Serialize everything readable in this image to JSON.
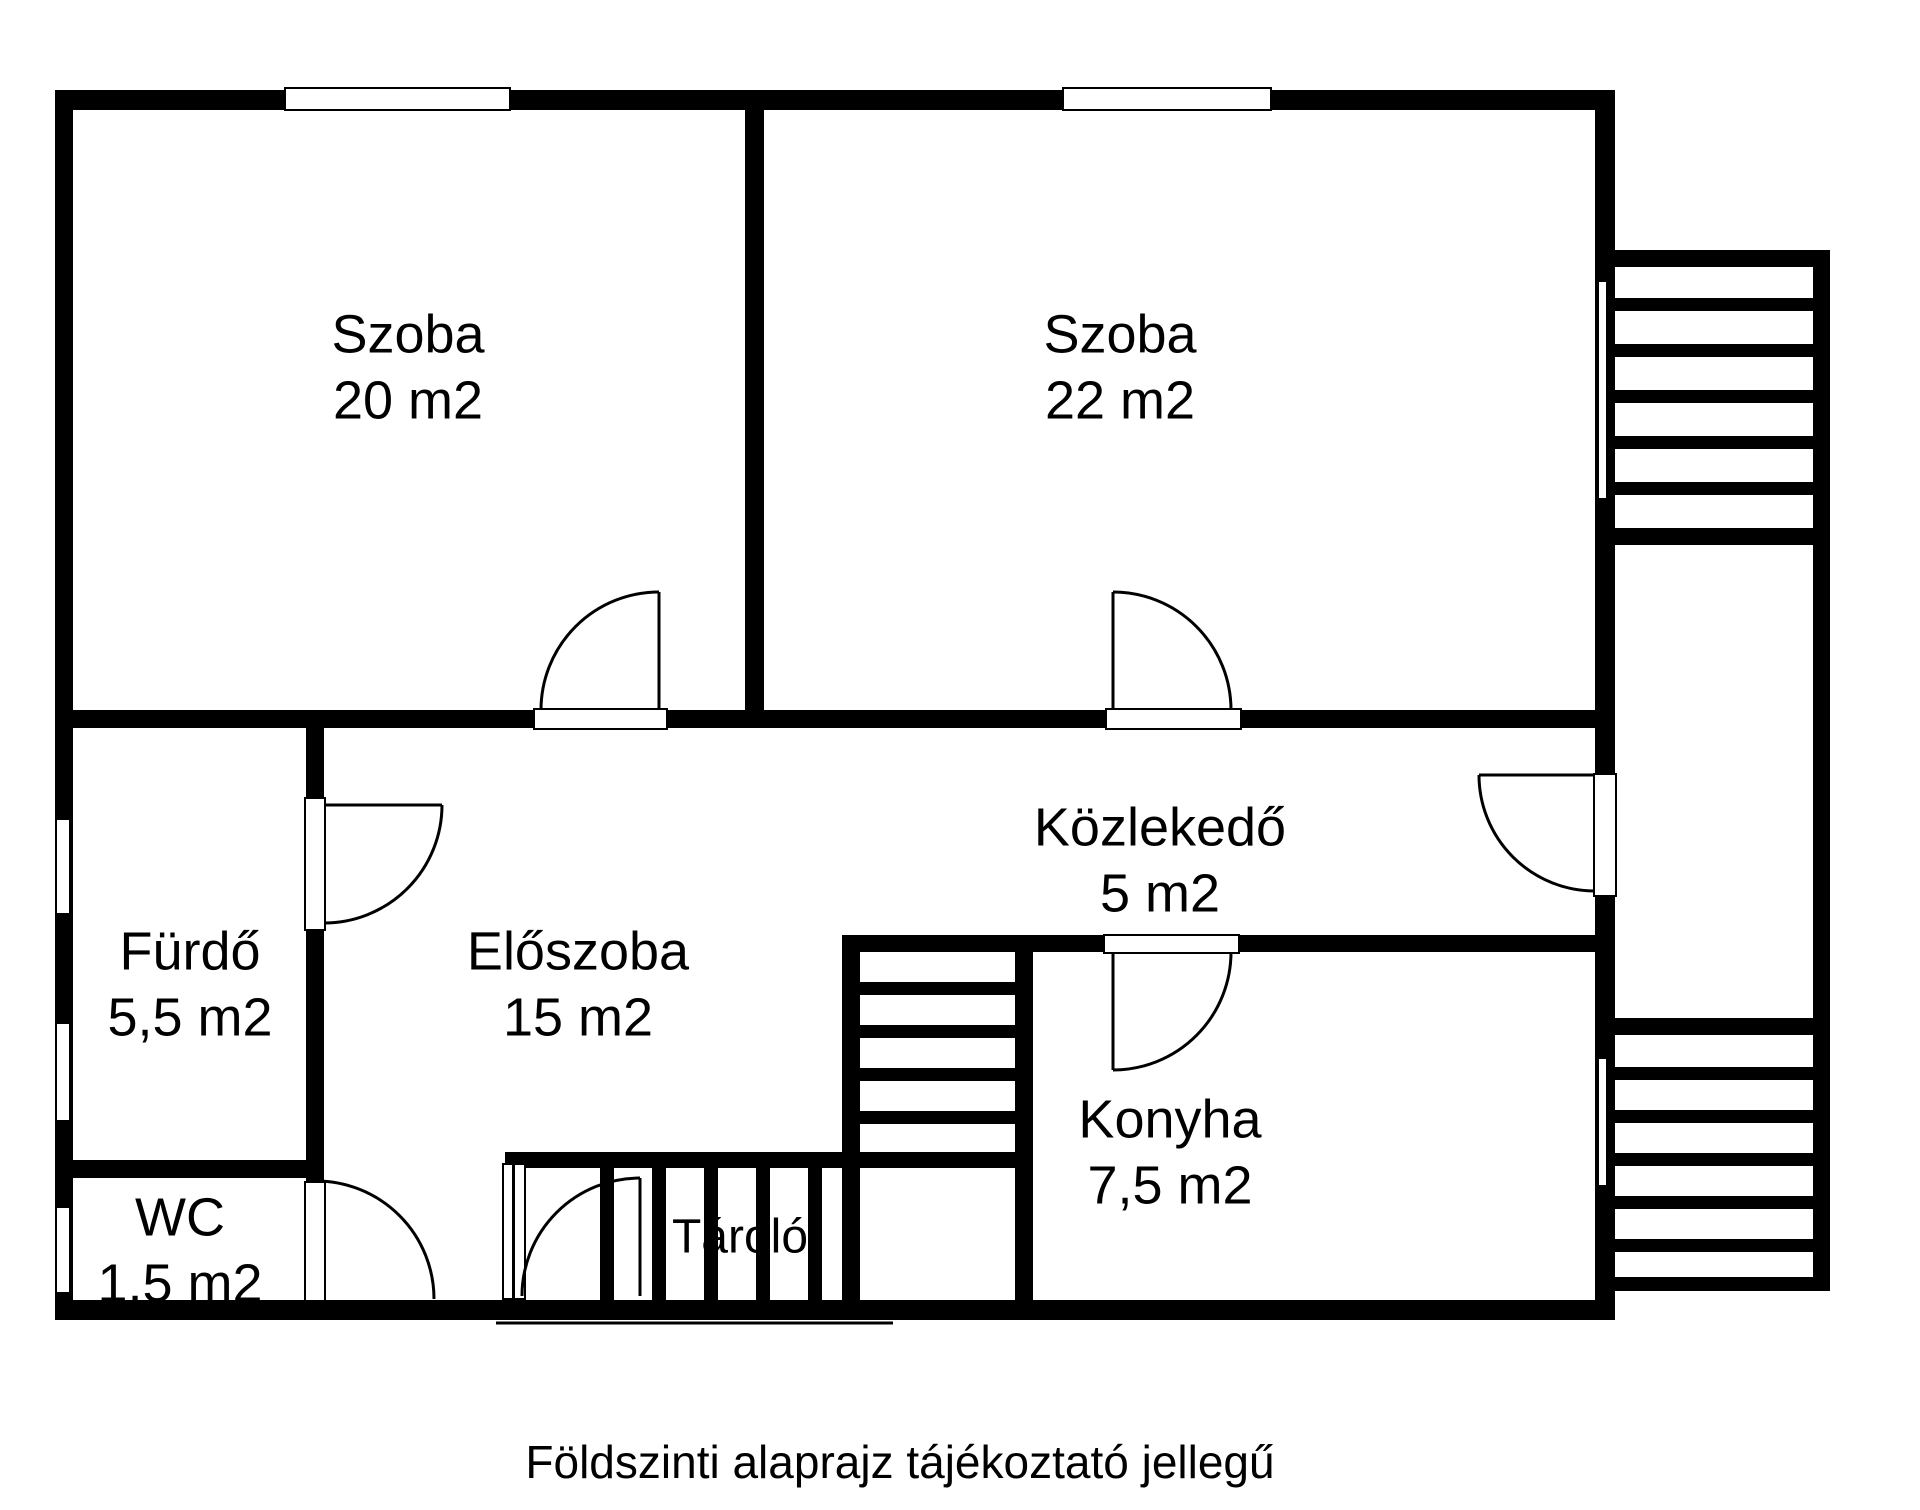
{
  "plan": {
    "caption": "Földszinti alaprajz tájékoztató jellegű",
    "colors": {
      "wall": "#000000",
      "background": "#ffffff"
    },
    "rooms": {
      "szoba1": {
        "name": "Szoba",
        "area": "20 m2"
      },
      "szoba2": {
        "name": "Szoba",
        "area": "22 m2"
      },
      "kozlekedo": {
        "name": "Közlekedő",
        "area": "5 m2"
      },
      "furdo": {
        "name": "Fürdő",
        "area": "5,5 m2"
      },
      "eloszoba": {
        "name": "Előszoba",
        "area": "15 m2"
      },
      "wc": {
        "name": "WC",
        "area": "1,5 m2"
      },
      "konyha": {
        "name": "Konyha",
        "area": "7,5 m2"
      },
      "tarolo": {
        "name": "Tároló"
      }
    }
  }
}
